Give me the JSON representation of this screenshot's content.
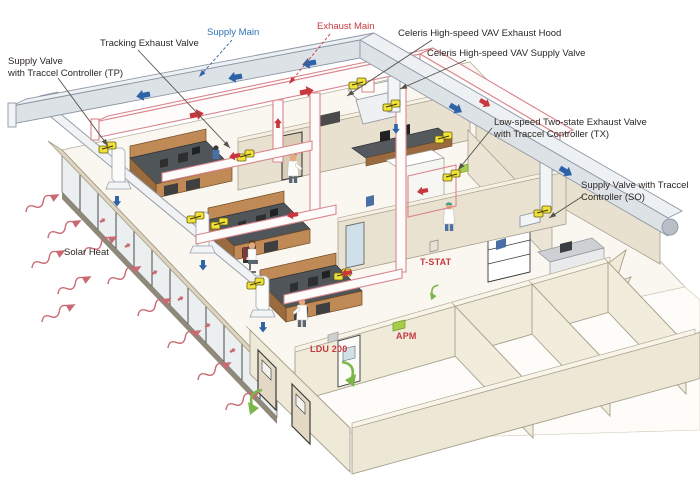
{
  "diagram": {
    "title": "Laboratory airflow control system isometric diagram",
    "labels": {
      "supply_valve_tp": "Supply Valve\nwith Traccel Controller (TP)",
      "tracking_exhaust_valve": "Tracking Exhaust Valve",
      "supply_main": "Supply Main",
      "exhaust_main": "Exhaust Main",
      "celeris_exhaust_hood": "Celeris High-speed VAV Exhaust Hood",
      "celeris_supply_valve": "Celeris High-speed VAV Supply Valve",
      "low_speed_tx": "Low-speed Two-state Exhaust Valve\nwith Traccel Controller (TX)",
      "supply_valve_so": "Supply Valve with Traccel\nController (SO)",
      "solar_heat": "Solar Heat",
      "t_stat": "T-STAT",
      "apm": "APM",
      "ldu_200": "LDU 200"
    },
    "colors": {
      "label_text": "#2b2623",
      "supply_label": "#2d72b5",
      "exhaust_label": "#c53a40",
      "wall_label": "#c53a40",
      "supply_flow": "#2d62a7",
      "exhaust_flow": "#c8373d",
      "solar_wave": "#c96a72",
      "valve_yellow": "#efe23a",
      "valve_stroke": "#6b5d10",
      "duct_gray": "#dde2e7",
      "duct_top": "#eef1f4",
      "duct_stroke": "#8d97a5",
      "exhaust_duct_fill": "#fdfcfb",
      "exhaust_duct_stroke": "#d9868d",
      "wall_beige": "#e8e1d0",
      "wall_light": "#f0ead9",
      "wall_band": "#ddd5c0",
      "wall_stroke": "#a79f8c",
      "floor": "#faf7f0",
      "glass": "#eceff0",
      "wood": "#c08a57",
      "wood_dark": "#9a6b3e",
      "bench_top": "#50555a",
      "green_arrow": "#7ab648",
      "leader": "#55504b"
    }
  }
}
